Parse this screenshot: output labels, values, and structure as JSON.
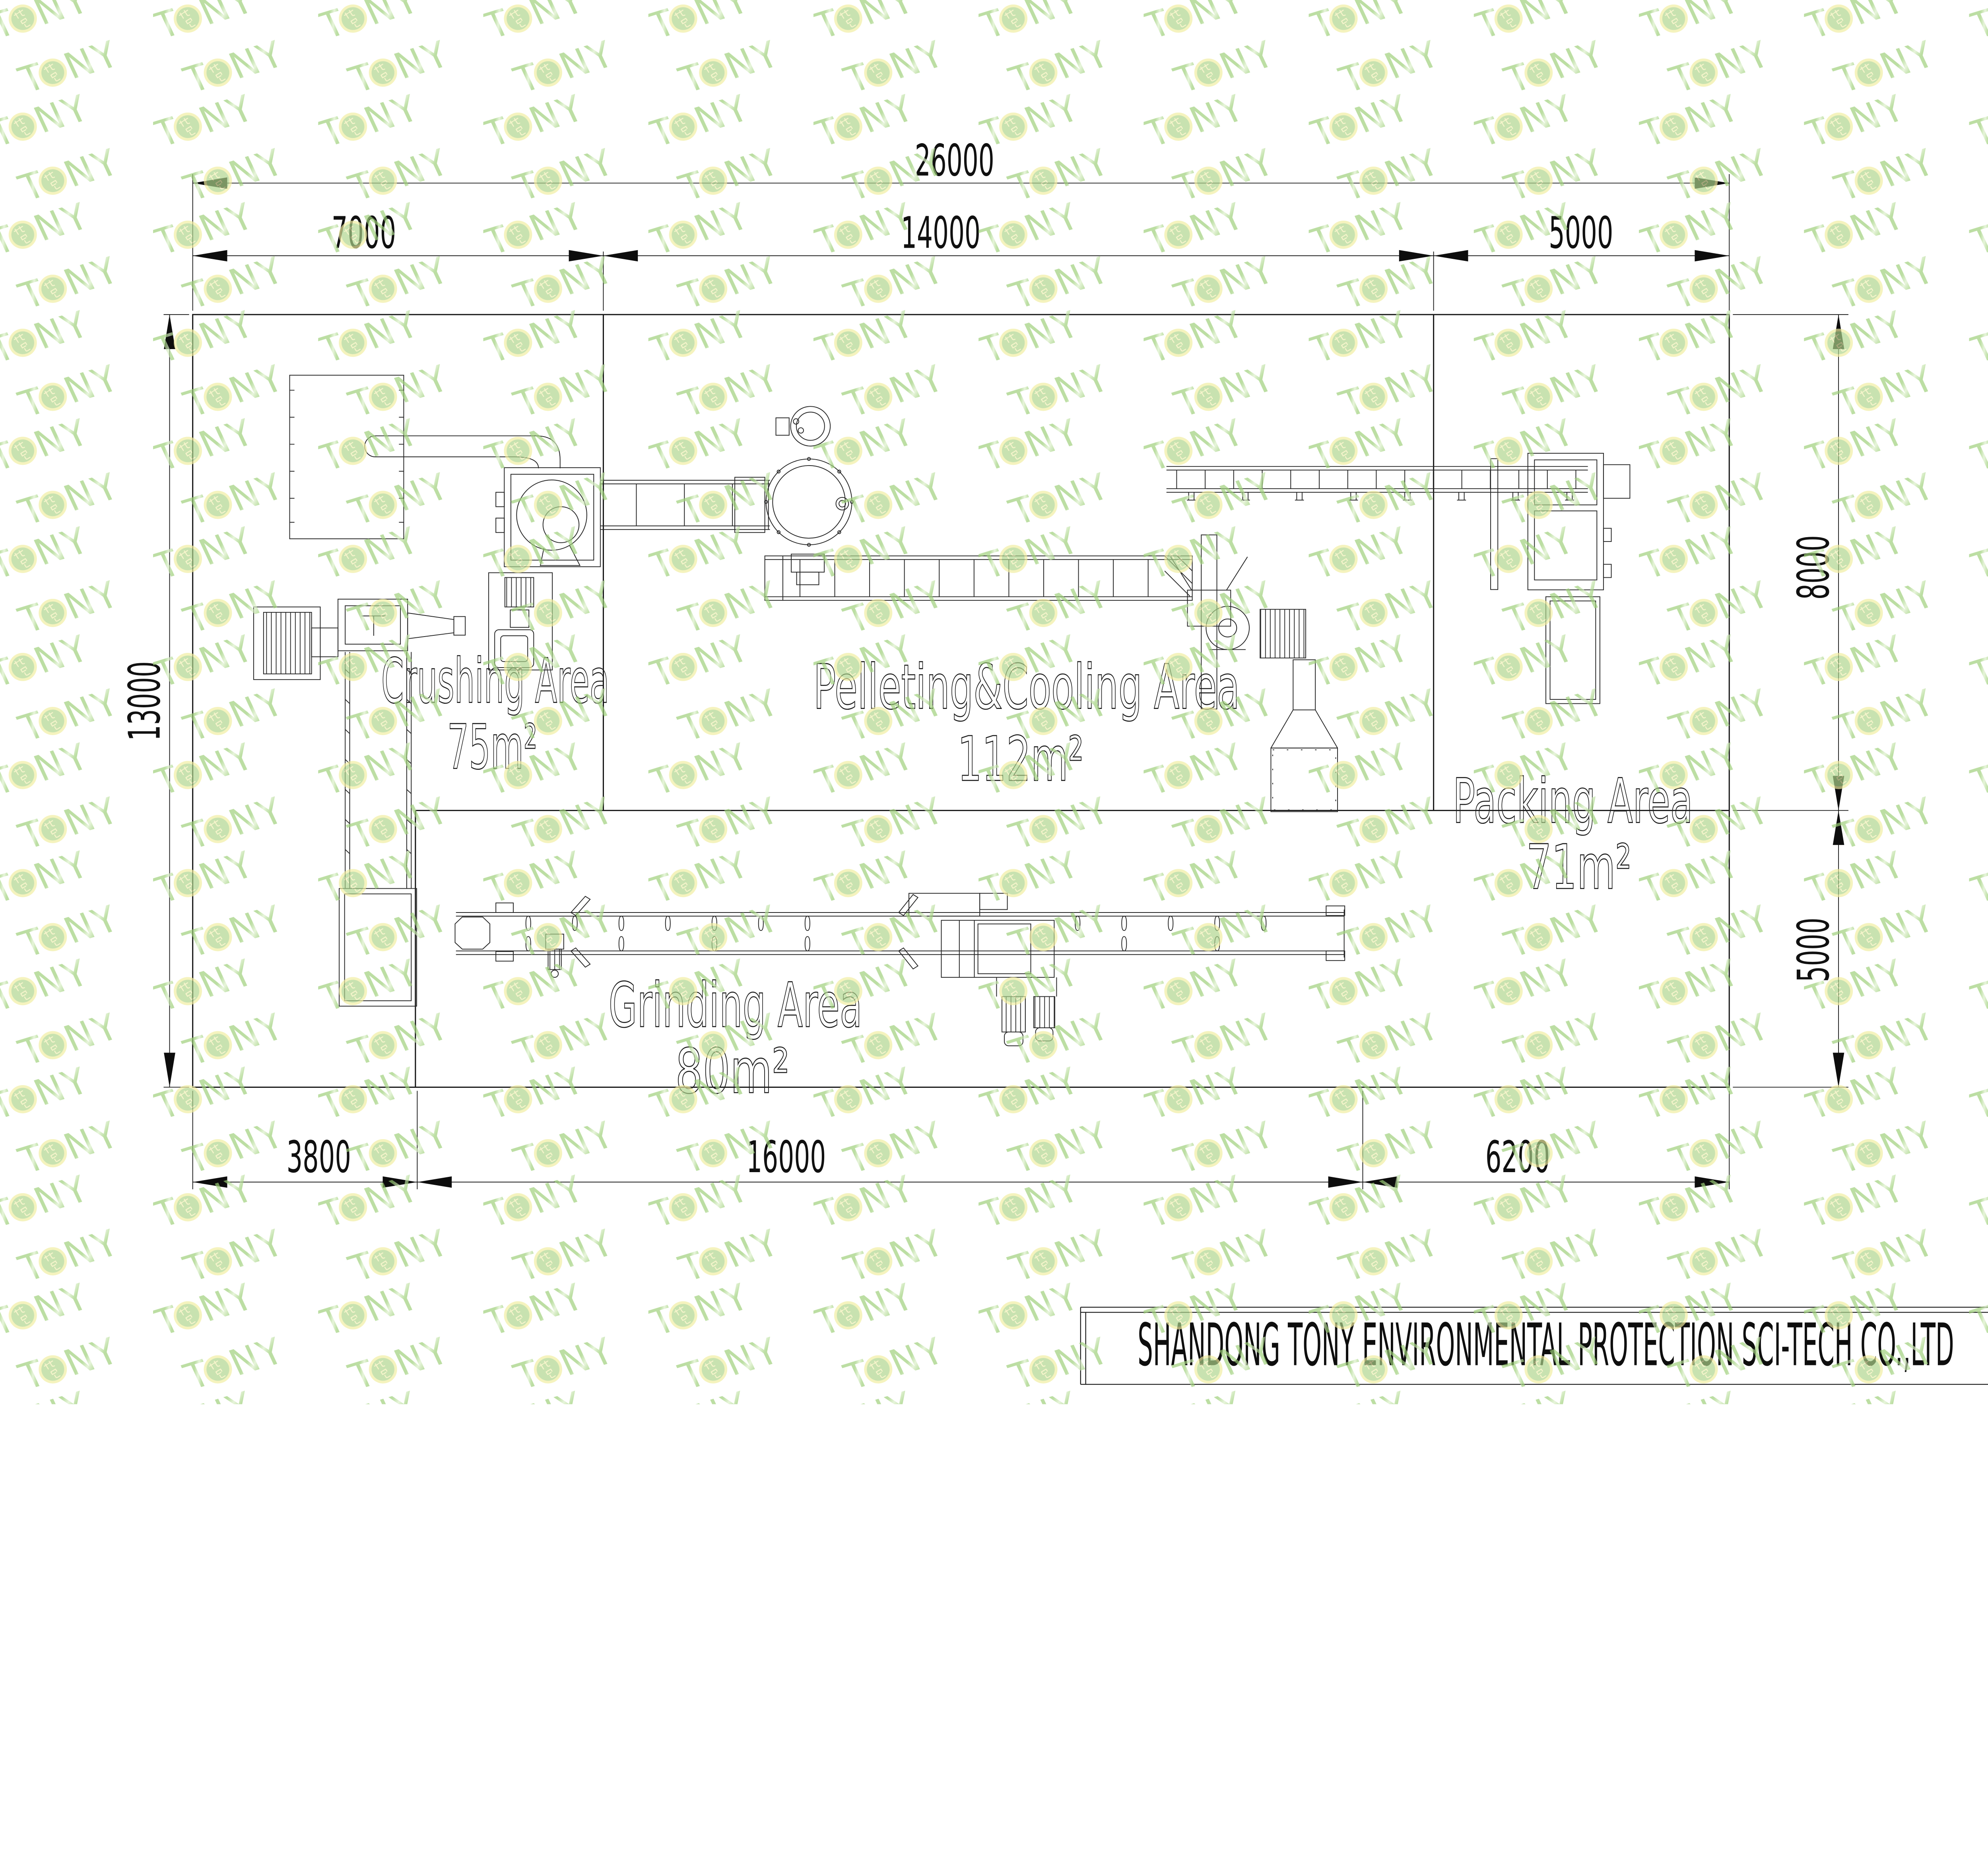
{
  "title": {
    "company": "SHANDONG TONY ENVIRONMENTAL PROTECTION SCI-TECH CO.,LTD"
  },
  "areas": {
    "crushing": {
      "name": "Crushing Area",
      "area": "75m²"
    },
    "pelleting": {
      "name": "Pelleting&Cooling Area",
      "area": "112m²"
    },
    "packing": {
      "name": "Packing Area",
      "area": "71m²"
    },
    "grinding": {
      "name": "Grinding Area",
      "area": "80m²"
    }
  },
  "dims": {
    "total_width": "26000",
    "top_left": "7000",
    "top_mid": "14000",
    "top_right": "5000",
    "left_height": "13000",
    "right_top": "8000",
    "right_bottom": "5000",
    "bottom_left": "3800",
    "bottom_mid": "16000",
    "bottom_right": "6200"
  },
  "watermark": {
    "t": "T",
    "ny": "NY",
    "badge_text": "托尼",
    "green": "#a8d78b",
    "badge_yellow": "#f0eda0",
    "badge_green": "#aed58b"
  }
}
